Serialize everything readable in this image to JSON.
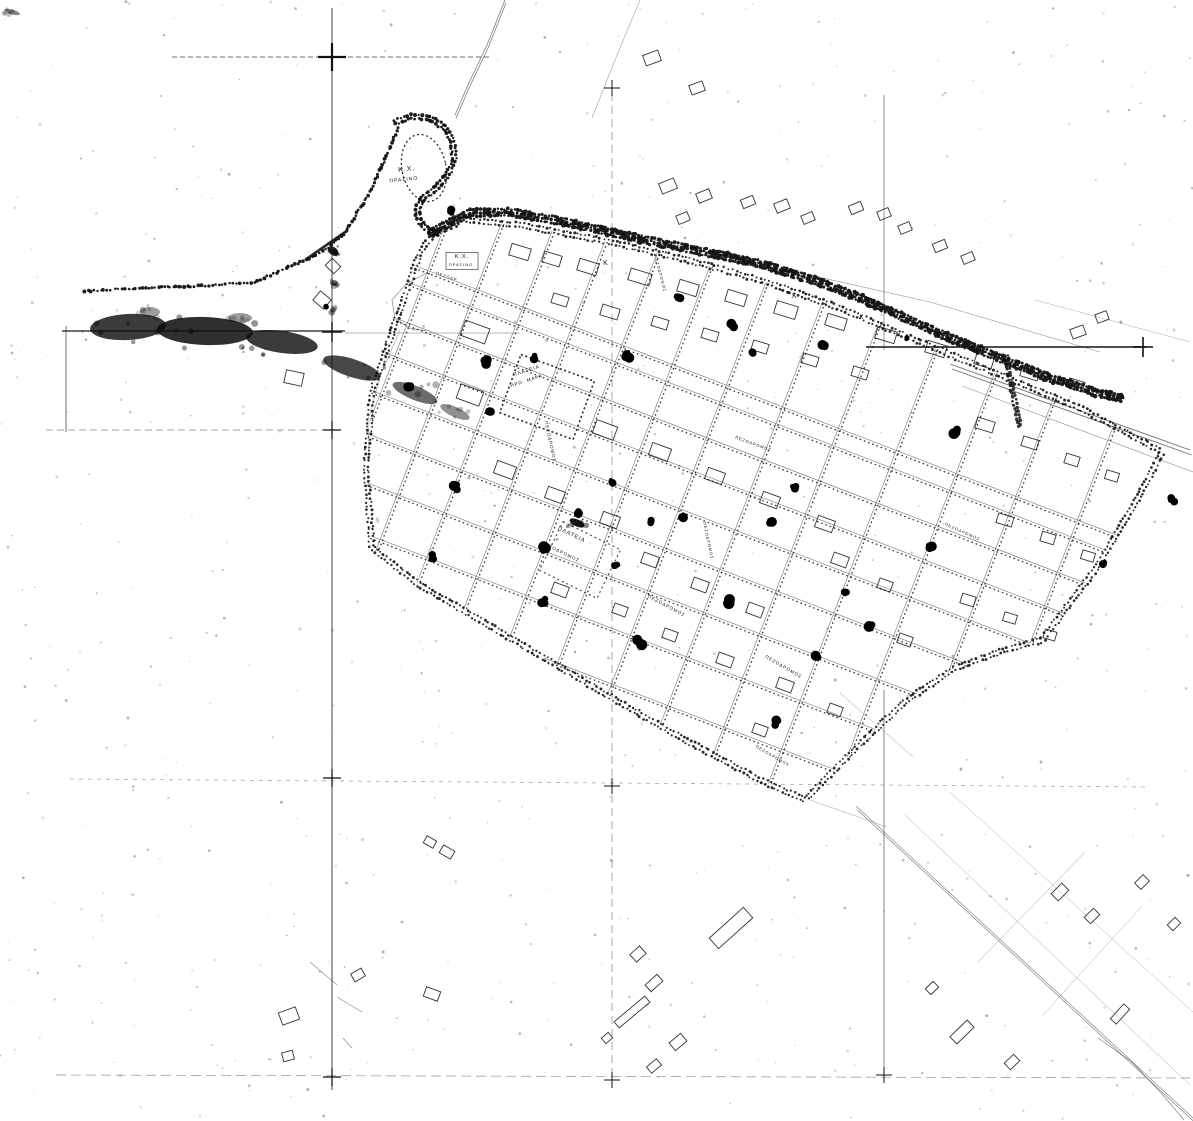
{
  "meta": {
    "kind": "scanned black-and-white town-plan map",
    "language": "Greek",
    "paper_color": "#ffffff",
    "ink_color": "#111111"
  },
  "labels": [
    {
      "text": "Κ.Χ.",
      "x": 407,
      "y": 171,
      "rot": -6,
      "size": 7
    },
    {
      "text": "ΠΡΑΣΙΝΟ",
      "x": 404,
      "y": 181,
      "rot": -6,
      "size": 5
    },
    {
      "text": "Κ.Χ.",
      "x": 462,
      "y": 258,
      "rot": 0,
      "size": 5.5
    },
    {
      "text": "ΠΡΑΣΙΝΟ",
      "x": 461,
      "y": 266,
      "rot": 0,
      "size": 4
    },
    {
      "text": "ΠΕΖΟΔΡ.",
      "x": 447,
      "y": 278,
      "rot": 18,
      "size": 4
    },
    {
      "text": "ΠΛΑΤΕΙΑ",
      "x": 527,
      "y": 372,
      "rot": -18,
      "size": 5
    },
    {
      "text": "ΗΡΩ. ΜΑΡΑ",
      "x": 527,
      "y": 382,
      "rot": -18,
      "size": 4.5
    },
    {
      "text": "ΠΕΖΟΔΡΟΜΟΣ",
      "x": 549,
      "y": 442,
      "rot": 78,
      "size": 4.5
    },
    {
      "text": "ΠΕΖΟΔΡΟΜΟΣ",
      "x": 659,
      "y": 274,
      "rot": 75,
      "size": 4
    },
    {
      "text": "ΠΛΑΤΕΙΑ",
      "x": 571,
      "y": 536,
      "rot": 26,
      "size": 5.5
    },
    {
      "text": "ΠΕΖΟΔΡΟΜΟΣ",
      "x": 560,
      "y": 553,
      "rot": 26,
      "size": 4.5
    },
    {
      "text": "ΠΕΖΟΔΡΟΜΟΣ",
      "x": 666,
      "y": 607,
      "rot": 28,
      "size": 4.5
    },
    {
      "text": "ΠΕΖΟΔΡΟΜΟΣ",
      "x": 753,
      "y": 445,
      "rot": 20,
      "size": 4
    },
    {
      "text": "ΠΕΖΟΔΡΟΜΟΣ",
      "x": 707,
      "y": 541,
      "rot": 78,
      "size": 4
    },
    {
      "text": "ΠΕΖΟΔΡΟΜΟΣ",
      "x": 783,
      "y": 668,
      "rot": 30,
      "size": 4.5
    },
    {
      "text": "ΠΕΖΟΔΡΟΜΟΣ",
      "x": 962,
      "y": 533,
      "rot": 24,
      "size": 4
    },
    {
      "text": "ΠΕΖΟΔΡΟΜΟΣ",
      "x": 772,
      "y": 757,
      "rot": 30,
      "size": 4
    },
    {
      "text": "Κ",
      "x": 606,
      "y": 265,
      "rot": 0,
      "size": 7
    },
    {
      "text": "Κ",
      "x": 795,
      "y": 298,
      "rot": 0,
      "size": 7
    },
    {
      "text": "Κ",
      "x": 862,
      "y": 319,
      "rot": 0,
      "size": 6
    }
  ],
  "fold_lines": [
    [
      332,
      8,
      332,
      1090,
      1.1,
      "",
      0.7
    ],
    [
      612,
      80,
      612,
      1086,
      0.8,
      "8 5",
      0.45
    ],
    [
      884,
      95,
      884,
      350,
      0.9,
      "",
      0.5
    ],
    [
      884,
      690,
      884,
      1072,
      0.9,
      "",
      0.55
    ],
    [
      172,
      57,
      492,
      57,
      1.0,
      "5 3",
      0.6
    ],
    [
      62,
      331,
      345,
      331,
      1.5,
      "",
      0.8
    ],
    [
      345,
      333,
      520,
      333,
      0.8,
      "",
      0.4
    ],
    [
      866,
      347,
      1146,
      347,
      1.7,
      "",
      0.85
    ],
    [
      46,
      430,
      335,
      430,
      0.8,
      "7 4",
      0.5
    ],
    [
      70,
      779,
      1150,
      787,
      0.7,
      "4 5",
      0.4
    ],
    [
      56,
      1075,
      1190,
      1078,
      0.7,
      "10 5",
      0.45
    ],
    [
      66,
      326,
      66,
      432,
      1.0,
      "",
      0.6
    ]
  ],
  "crosshairs": [
    [
      332,
      57,
      14,
      2.2
    ],
    [
      332,
      332,
      10,
      1.4
    ],
    [
      332,
      430,
      9,
      1.2
    ],
    [
      332,
      778,
      9,
      1.2
    ],
    [
      332,
      1077,
      9,
      1.2
    ],
    [
      612,
      88,
      8,
      1
    ],
    [
      612,
      786,
      8,
      1
    ],
    [
      612,
      1080,
      8,
      1
    ],
    [
      1143,
      347,
      10,
      1.6
    ],
    [
      884,
      1075,
      8,
      1
    ]
  ],
  "boundary": [
    [
      397,
      318
    ],
    [
      372,
      392
    ],
    [
      366,
      470
    ],
    [
      372,
      548
    ],
    [
      420,
      585
    ],
    [
      500,
      632
    ],
    [
      590,
      685
    ],
    [
      680,
      737
    ],
    [
      760,
      780
    ],
    [
      805,
      800
    ],
    [
      862,
      742
    ],
    [
      905,
      702
    ],
    [
      955,
      668
    ],
    [
      1005,
      650
    ],
    [
      1042,
      640
    ],
    [
      1095,
      570
    ],
    [
      1138,
      498
    ],
    [
      1162,
      452
    ],
    [
      1080,
      408
    ],
    [
      1000,
      375
    ],
    [
      920,
      342
    ],
    [
      840,
      308
    ],
    [
      760,
      280
    ],
    [
      680,
      258
    ],
    [
      600,
      240
    ],
    [
      520,
      225
    ],
    [
      462,
      220
    ],
    [
      432,
      236
    ],
    [
      420,
      252
    ]
  ],
  "grid": {
    "origin": [
      424,
      252
    ],
    "angleA": 21,
    "angleB": 111,
    "aOffsets": [
      16,
      34,
      72,
      108,
      148,
      190,
      236,
      284,
      336,
      392,
      450,
      508
    ],
    "bOffsets": [
      -45,
      10,
      62,
      112,
      165,
      218,
      272,
      330,
      390,
      450,
      512,
      576,
      640,
      706,
      770
    ]
  },
  "avenue": [
    [
      430,
      233
    ],
    [
      470,
      213
    ],
    [
      510,
      212
    ],
    [
      560,
      221
    ],
    [
      610,
      232
    ],
    [
      660,
      243
    ],
    [
      710,
      253
    ],
    [
      760,
      264
    ],
    [
      810,
      279
    ],
    [
      860,
      298
    ],
    [
      910,
      320
    ],
    [
      955,
      340
    ],
    [
      1000,
      358
    ],
    [
      1050,
      378
    ],
    [
      1095,
      392
    ],
    [
      1125,
      399
    ]
  ],
  "hook": [
    [
      395,
      122
    ],
    [
      412,
      116
    ],
    [
      430,
      118
    ],
    [
      445,
      128
    ],
    [
      453,
      143
    ],
    [
      454,
      160
    ],
    [
      447,
      176
    ],
    [
      436,
      188
    ],
    [
      424,
      197
    ],
    [
      417,
      208
    ],
    [
      419,
      221
    ],
    [
      428,
      230
    ],
    [
      440,
      234
    ]
  ],
  "coast": [
    [
      85,
      291
    ],
    [
      140,
      288
    ],
    [
      200,
      286
    ],
    [
      255,
      282
    ],
    [
      305,
      260
    ],
    [
      322,
      252
    ],
    [
      345,
      233
    ],
    [
      368,
      195
    ],
    [
      385,
      160
    ],
    [
      395,
      135
    ],
    [
      400,
      124
    ]
  ],
  "coast_solid": [
    [
      305,
      260
    ],
    [
      348,
      230
    ]
  ],
  "short_band": [
    [
      1006,
      356
    ],
    [
      1020,
      428
    ]
  ],
  "roads": [
    {
      "pts": [
        [
          505,
          0
        ],
        [
          487,
          45
        ],
        [
          468,
          85
        ],
        [
          455,
          115
        ]
      ],
      "w": 0.8,
      "op": 0.55,
      "double": 3
    },
    {
      "pts": [
        [
          640,
          0
        ],
        [
          615,
          60
        ],
        [
          592,
          118
        ]
      ],
      "w": 0.6,
      "op": 0.4
    },
    {
      "pts": [
        [
          600,
          228
        ],
        [
          930,
          302
        ],
        [
          1100,
          352
        ]
      ],
      "w": 0.6,
      "op": 0.45
    },
    {
      "pts": [
        [
          950,
          364
        ],
        [
          1190,
          450
        ]
      ],
      "w": 0.9,
      "op": 0.6,
      "double": 5
    },
    {
      "pts": [
        [
          962,
          386
        ],
        [
          1193,
          472
        ]
      ],
      "w": 0.6,
      "op": 0.45
    },
    {
      "pts": [
        [
          856,
          806
        ],
        [
          1193,
          1118
        ]
      ],
      "w": 0.7,
      "op": 0.5,
      "double": 4
    },
    {
      "pts": [
        [
          905,
          815
        ],
        [
          1190,
          1085
        ]
      ],
      "w": 0.5,
      "op": 0.38
    },
    {
      "pts": [
        [
          950,
          792
        ],
        [
          1193,
          1012
        ]
      ],
      "w": 0.5,
      "op": 0.35
    },
    {
      "pts": [
        [
          1085,
          852
        ],
        [
          978,
          962
        ]
      ],
      "w": 0.5,
      "op": 0.4
    },
    {
      "pts": [
        [
          1142,
          906
        ],
        [
          1042,
          1016
        ]
      ],
      "w": 0.5,
      "op": 0.35
    },
    {
      "pts": [
        [
          1098,
          1038
        ],
        [
          1132,
          1062
        ],
        [
          1162,
          1094
        ],
        [
          1184,
          1120
        ]
      ],
      "w": 0.7,
      "op": 0.5
    },
    {
      "pts": [
        [
          840,
          693
        ],
        [
          913,
          757
        ]
      ],
      "w": 0.5,
      "op": 0.4
    },
    {
      "pts": [
        [
          810,
          800
        ],
        [
          887,
          827
        ]
      ],
      "w": 0.5,
      "op": 0.4
    },
    {
      "pts": [
        [
          428,
          272
        ],
        [
          406,
          284
        ],
        [
          392,
          300
        ],
        [
          395,
          318
        ],
        [
          409,
          328
        ],
        [
          426,
          331
        ]
      ],
      "w": 0.7,
      "op": 0.5
    },
    {
      "pts": [
        [
          400,
          330
        ],
        [
          381,
          374
        ],
        [
          368,
          420
        ],
        [
          369,
          462
        ]
      ],
      "w": 0.6,
      "op": 0.4
    },
    {
      "pts": [
        [
          1035,
          300
        ],
        [
          1190,
          342
        ]
      ],
      "w": 0.5,
      "op": 0.35
    },
    {
      "pts": [
        [
          310,
          962
        ],
        [
          337,
          985
        ]
      ],
      "w": 0.6,
      "op": 0.5
    },
    {
      "pts": [
        [
          337,
          997
        ],
        [
          362,
          1012
        ]
      ],
      "w": 0.6,
      "op": 0.5
    },
    {
      "pts": [
        [
          343,
          1038
        ],
        [
          352,
          1048
        ]
      ],
      "w": 0.6,
      "op": 0.5
    }
  ],
  "dotted_shapes": [
    {
      "type": "ellipse",
      "x": 424,
      "y": 168,
      "rx": 22,
      "ry": 34,
      "rot": -12,
      "w": 1.3,
      "dash": "2 2.6",
      "op": 0.9
    },
    {
      "type": "rect",
      "x": 547,
      "y": 397,
      "w": 78,
      "h": 62,
      "rot": 20,
      "sw": 1.6,
      "dash": "2 2.6",
      "op": 0.9
    },
    {
      "type": "rect",
      "x": 580,
      "y": 560,
      "w": 64,
      "h": 54,
      "rot": 26,
      "sw": 1.2,
      "dash": "2 3",
      "op": 0.75
    },
    {
      "type": "rect",
      "x": 462,
      "y": 261,
      "w": 32,
      "h": 17,
      "rot": 0,
      "sw": 0.7,
      "dash": "",
      "op": 0.8
    }
  ],
  "buildings": [
    [
      520,
      252,
      20,
      12,
      17
    ],
    [
      552,
      259,
      18,
      11,
      17
    ],
    [
      588,
      267,
      20,
      12,
      17
    ],
    [
      640,
      277,
      22,
      12,
      17
    ],
    [
      688,
      288,
      20,
      12,
      17
    ],
    [
      736,
      298,
      20,
      12,
      17
    ],
    [
      786,
      310,
      22,
      13,
      17
    ],
    [
      836,
      322,
      20,
      12,
      17
    ],
    [
      886,
      335,
      20,
      12,
      17
    ],
    [
      936,
      349,
      20,
      12,
      17
    ],
    [
      984,
      361,
      18,
      11,
      17
    ],
    [
      1030,
      373,
      18,
      11,
      17
    ],
    [
      1076,
      385,
      16,
      10,
      17
    ],
    [
      560,
      300,
      16,
      10,
      17
    ],
    [
      610,
      312,
      18,
      11,
      17
    ],
    [
      660,
      323,
      16,
      10,
      17
    ],
    [
      710,
      335,
      16,
      10,
      17
    ],
    [
      760,
      347,
      16,
      10,
      17
    ],
    [
      810,
      360,
      16,
      10,
      17
    ],
    [
      860,
      373,
      16,
      10,
      17
    ],
    [
      475,
      332,
      26,
      16,
      20
    ],
    [
      470,
      395,
      24,
      15,
      20
    ],
    [
      505,
      470,
      20,
      13,
      20
    ],
    [
      555,
      495,
      18,
      12,
      20
    ],
    [
      610,
      520,
      18,
      12,
      20
    ],
    [
      605,
      430,
      22,
      14,
      20
    ],
    [
      660,
      452,
      20,
      13,
      20
    ],
    [
      715,
      476,
      18,
      12,
      20
    ],
    [
      770,
      500,
      18,
      12,
      20
    ],
    [
      825,
      524,
      18,
      12,
      20
    ],
    [
      650,
      560,
      16,
      11,
      20
    ],
    [
      700,
      585,
      16,
      11,
      20
    ],
    [
      755,
      610,
      16,
      11,
      20
    ],
    [
      620,
      610,
      14,
      10,
      20
    ],
    [
      670,
      635,
      14,
      10,
      20
    ],
    [
      725,
      660,
      16,
      11,
      20
    ],
    [
      785,
      685,
      16,
      11,
      20
    ],
    [
      560,
      590,
      16,
      11,
      20
    ],
    [
      840,
      560,
      16,
      11,
      20
    ],
    [
      885,
      585,
      14,
      10,
      20
    ],
    [
      905,
      640,
      14,
      10,
      20
    ],
    [
      835,
      710,
      14,
      10,
      20
    ],
    [
      760,
      730,
      14,
      10,
      20
    ],
    [
      985,
      425,
      18,
      11,
      17
    ],
    [
      1030,
      443,
      16,
      10,
      17
    ],
    [
      1072,
      460,
      14,
      10,
      17
    ],
    [
      1112,
      476,
      13,
      9,
      17
    ],
    [
      1005,
      520,
      16,
      10,
      17
    ],
    [
      1048,
      538,
      14,
      10,
      17
    ],
    [
      1088,
      556,
      13,
      9,
      17
    ],
    [
      968,
      600,
      14,
      10,
      17
    ],
    [
      1010,
      618,
      13,
      9,
      17
    ],
    [
      1050,
      635,
      12,
      9,
      17
    ],
    [
      668,
      186,
      16,
      11,
      -22
    ],
    [
      704,
      196,
      14,
      10,
      -22
    ],
    [
      683,
      218,
      12,
      9,
      -22
    ],
    [
      748,
      202,
      13,
      9,
      -22
    ],
    [
      782,
      206,
      14,
      10,
      -22
    ],
    [
      808,
      218,
      12,
      9,
      -22
    ],
    [
      856,
      208,
      13,
      9,
      -22
    ],
    [
      884,
      214,
      12,
      9,
      -22
    ],
    [
      905,
      228,
      12,
      9,
      -22
    ],
    [
      940,
      246,
      13,
      9,
      -22
    ],
    [
      968,
      258,
      12,
      9,
      -22
    ],
    [
      1078,
      332,
      14,
      10,
      -20
    ],
    [
      1102,
      317,
      12,
      9,
      -20
    ],
    [
      652,
      58,
      16,
      11,
      -20
    ],
    [
      697,
      88,
      14,
      10,
      -20
    ],
    [
      294,
      378,
      18,
      13,
      12
    ],
    [
      333,
      266,
      12,
      10,
      45
    ],
    [
      322,
      300,
      14,
      12,
      40
    ],
    [
      731,
      928,
      46,
      14,
      -42
    ],
    [
      638,
      954,
      13,
      10,
      -42
    ],
    [
      654,
      983,
      16,
      9,
      -42
    ],
    [
      632,
      1012,
      40,
      8,
      -40
    ],
    [
      678,
      1042,
      15,
      10,
      -40
    ],
    [
      607,
      1038,
      9,
      7,
      -40
    ],
    [
      654,
      1066,
      13,
      8,
      -40
    ],
    [
      289,
      1016,
      18,
      13,
      -20
    ],
    [
      288,
      1056,
      11,
      9,
      -15
    ],
    [
      358,
      975,
      12,
      9,
      -30
    ],
    [
      432,
      994,
      15,
      10,
      20
    ],
    [
      447,
      852,
      13,
      9,
      30
    ],
    [
      430,
      842,
      11,
      8,
      30
    ],
    [
      1060,
      892,
      15,
      10,
      -45
    ],
    [
      1092,
      916,
      13,
      9,
      -45
    ],
    [
      1142,
      882,
      12,
      9,
      -45
    ],
    [
      1174,
      924,
      11,
      8,
      -45
    ],
    [
      962,
      1032,
      24,
      10,
      -44
    ],
    [
      1012,
      1062,
      13,
      9,
      -44
    ],
    [
      932,
      988,
      11,
      8,
      -44
    ],
    [
      1120,
      1014,
      20,
      8,
      -48
    ]
  ],
  "trees": [
    [
      452,
      211,
      5
    ],
    [
      408,
      385,
      6
    ],
    [
      487,
      362,
      5
    ],
    [
      489,
      413,
      6
    ],
    [
      534,
      357,
      5
    ],
    [
      627,
      357,
      6
    ],
    [
      679,
      297,
      5
    ],
    [
      733,
      325,
      5
    ],
    [
      753,
      352,
      4
    ],
    [
      824,
      345,
      5
    ],
    [
      906,
      338,
      4
    ],
    [
      955,
      432,
      6
    ],
    [
      931,
      546,
      5
    ],
    [
      544,
      548,
      6
    ],
    [
      455,
      487,
      6
    ],
    [
      434,
      557,
      6
    ],
    [
      579,
      512,
      5
    ],
    [
      612,
      482,
      4
    ],
    [
      650,
      522,
      4
    ],
    [
      684,
      517,
      5
    ],
    [
      640,
      642,
      6
    ],
    [
      727,
      602,
      6
    ],
    [
      772,
      522,
      5
    ],
    [
      795,
      488,
      5
    ],
    [
      846,
      592,
      4
    ],
    [
      871,
      627,
      6
    ],
    [
      816,
      657,
      5
    ],
    [
      777,
      723,
      6
    ],
    [
      1172,
      500,
      5
    ],
    [
      1104,
      563,
      4
    ],
    [
      543,
      601,
      5
    ],
    [
      616,
      564,
      4
    ],
    [
      327,
      306,
      3
    ]
  ],
  "smudges": [
    [
      128,
      327,
      38,
      13,
      -3,
      0.8
    ],
    [
      205,
      331,
      48,
      14,
      2,
      0.85
    ],
    [
      282,
      342,
      36,
      11,
      8,
      0.8
    ],
    [
      352,
      368,
      30,
      9,
      18,
      0.75
    ],
    [
      415,
      393,
      24,
      7,
      22,
      0.6
    ],
    [
      455,
      412,
      16,
      5,
      24,
      0.45
    ],
    [
      150,
      312,
      10,
      5,
      0,
      0.4
    ],
    [
      240,
      318,
      12,
      5,
      0,
      0.4
    ],
    [
      333,
      251,
      6,
      4,
      40,
      0.85
    ],
    [
      334,
      283,
      4,
      3,
      0,
      0.6
    ],
    [
      333,
      310,
      3,
      2.5,
      0,
      0.5
    ],
    [
      577,
      523,
      8,
      3.5,
      25,
      0.95
    ],
    [
      12,
      12,
      8,
      2.5,
      15,
      0.5
    ]
  ],
  "noise": {
    "count": 800,
    "seed": 421
  }
}
